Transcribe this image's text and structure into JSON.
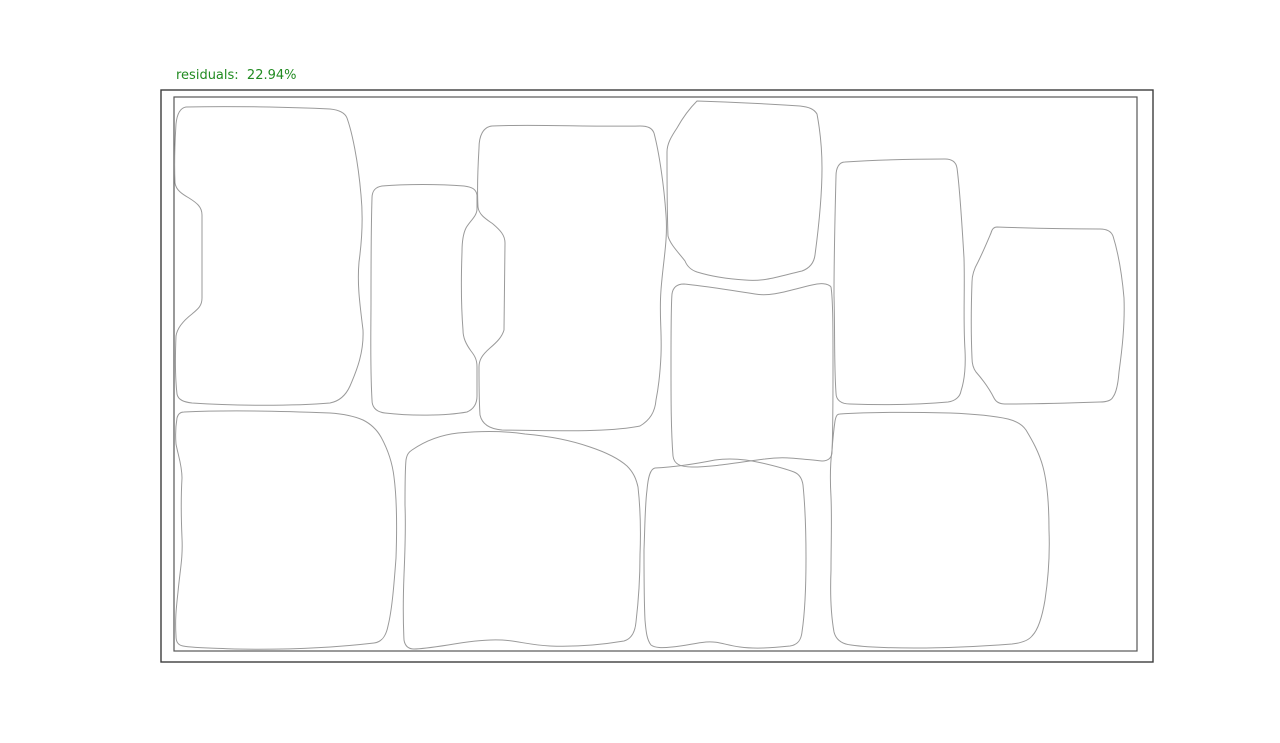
{
  "figure": {
    "label": {
      "text": "residuals:  22.94%",
      "color": "#228b22"
    },
    "frame": {
      "background": "#ffffff",
      "outer_color": "#3d3d3d",
      "inner_color": "#565656"
    },
    "stone_outline_color": "#9a9a9a",
    "stone_count": 11,
    "stones": [
      {
        "name": "stone-top-left",
        "d": "M 186,107 C 230,106 290,107 330,109 C 340,110 345,113 347,118 C 352,132 358,160 361,195 C 363,215 362,240 359,262 C 357,285 360,305 363,330 C 364,352 357,370 350,386 C 346,395 340,401 330,403 C 295,406 235,406 192,403 C 184,402 178,400 177,394 C 175,377 175,360 176,336 C 177,329 183,321 192,314 C 198,309 202,306 202,298 L 202,215 C 202,207 197,203 189,198 C 182,194 176,190 175,183 C 174,160 175,140 176,124 C 177,114 180,108 186,107 Z"
      },
      {
        "name": "stone-top-narrow",
        "d": "M 382,186 C 405,184 440,184 464,186 C 472,187 476,189 477,195 L 477,209 C 477,216 470,221 466,228 C 463,234 462,242 462,252 C 461,280 461,305 463,330 C 463,338 466,344 471,351 C 475,356 477,360 477,367 L 477,396 C 477,404 474,409 467,412 C 445,416 410,416 385,413 C 377,412 372,408 372,400 C 370,365 371,330 371,300 C 371,265 371,230 372,198 C 372,190 376,187 382,186 Z"
      },
      {
        "name": "stone-top-center-large",
        "d": "M 492,126 C 530,124 590,127 640,126 C 648,126 652,128 654,133 C 659,152 664,185 666,215 C 668,240 663,262 661,290 C 659,315 662,330 661,355 C 660,377 658,390 656,400 C 655,412 650,420 640,426 C 610,432 565,431 502,430 C 490,429 482,424 480,415 C 479,400 479,380 479,367 C 479,360 482,355 490,348 C 497,342 502,337 504,330 L 505,243 C 505,235 500,230 493,224 C 486,219 479,215 478,207 C 477,190 478,165 479,148 C 479,136 483,127 492,126 Z"
      },
      {
        "name": "stone-top-middle",
        "d": "M 697,101 C 730,102 770,104 800,106 C 809,107 814,109 817,114 C 820,130 822,150 822,168 C 822,195 819,225 815,255 C 814,263 810,268 802,271 C 780,276 765,282 745,280 C 728,279 710,276 697,272 C 691,270 687,266 685,261 C 678,252 670,244 668,236 C 667,210 667,180 667,152 C 667,144 671,137 677,128 C 682,119 688,110 697,101 Z"
      },
      {
        "name": "stone-center",
        "d": "M 684,284 C 705,286 730,290 755,294 C 772,297 790,290 812,285 C 820,283 828,283 831,287 C 833,300 833,330 833,365 C 833,400 833,430 832,452 C 832,458 828,461 822,461 C 800,459 785,456 765,459 C 740,462 715,467 692,467 C 680,467 674,464 673,456 C 671,430 671,400 671,365 C 671,330 671,305 672,294 C 673,287 677,284 684,284 Z"
      },
      {
        "name": "stone-tall-right",
        "d": "M 845,162 C 875,160 915,159 945,159 C 952,159 956,162 957,168 C 960,190 962,225 964,258 C 965,290 963,320 965,350 C 966,370 964,382 961,391 C 960,397 955,401 948,402 C 915,405 880,405 850,404 C 841,404 836,400 836,393 C 834,365 835,330 834,295 C 834,255 835,215 836,176 C 836,168 839,162 845,162 Z"
      },
      {
        "name": "stone-far-right",
        "d": "M 997,227 C 1025,228 1065,229 1100,229 C 1106,229 1111,231 1113,236 C 1118,252 1122,275 1124,298 C 1125,325 1122,350 1119,372 C 1118,385 1116,393 1113,397 C 1111,401 1106,402 1100,402 C 1070,403 1035,404 1005,404 C 1000,404 996,402 994,398 C 990,390 983,380 976,372 C 973,368 972,364 972,358 C 971,335 971,310 972,282 C 972,275 974,269 978,262 C 983,252 988,240 991,233 C 992,229 994,227 997,227 Z"
      },
      {
        "name": "stone-bottom-left",
        "d": "M 184,412 C 225,410 280,411 330,413 C 344,414 354,416 363,420 C 371,424 377,430 381,437 C 387,448 392,460 394,477 C 397,500 397,530 396,558 C 394,585 392,610 388,626 C 386,636 382,642 374,643 C 340,647 290,650 235,649 C 210,648 193,648 183,646 C 178,645 176,642 176,636 C 175,620 176,610 178,592 C 180,570 183,558 182,538 C 181,515 181,495 182,478 C 182,465 178,455 176,444 C 175,432 176,424 177,418 C 178,414 180,412 184,412 Z"
      },
      {
        "name": "stone-bottom-center-left",
        "d": "M 412,450 C 425,441 440,435 458,433 C 480,431 505,431 525,434 C 548,436 570,440 590,447 C 605,452 618,458 627,466 C 633,472 636,478 638,487 C 640,505 641,530 640,555 C 640,580 638,605 636,622 C 635,633 631,639 624,641 C 600,645 575,647 550,646 C 530,645 518,641 502,640 C 485,639 465,642 448,645 C 435,647 422,649 414,649 C 408,649 405,646 404,640 C 403,620 403,600 404,575 C 405,550 406,530 405,505 C 405,485 405,470 406,460 C 407,454 409,452 412,450 Z"
      },
      {
        "name": "stone-bottom-center",
        "d": "M 655,468 C 675,467 695,464 715,460 C 730,458 745,459 762,463 C 775,466 786,469 794,472 C 799,474 802,478 803,485 C 805,505 806,532 806,558 C 806,585 805,612 802,632 C 801,641 797,645 790,646 C 770,648 755,649 740,647 C 725,645 718,641 706,642 C 695,643 685,646 672,647 C 662,648 655,648 651,645 C 647,640 646,632 645,620 C 644,600 644,575 644,550 C 645,525 645,505 647,490 C 648,478 650,469 655,468 Z"
      },
      {
        "name": "stone-bottom-right",
        "d": "M 840,414 C 870,412 910,412 950,413 C 975,414 995,416 1008,419 C 1016,421 1022,424 1026,430 C 1032,440 1039,452 1043,467 C 1047,482 1049,505 1049,530 C 1050,555 1048,580 1045,600 C 1042,618 1038,630 1032,636 C 1028,641 1021,643 1012,644 C 985,646 950,648 915,648 C 890,648 865,647 851,645 C 842,644 836,640 834,632 C 831,615 830,595 831,570 C 831,545 832,520 831,497 C 830,480 830,465 832,450 C 833,437 834,428 835,421 C 836,416 837,414 840,414 Z"
      }
    ]
  }
}
